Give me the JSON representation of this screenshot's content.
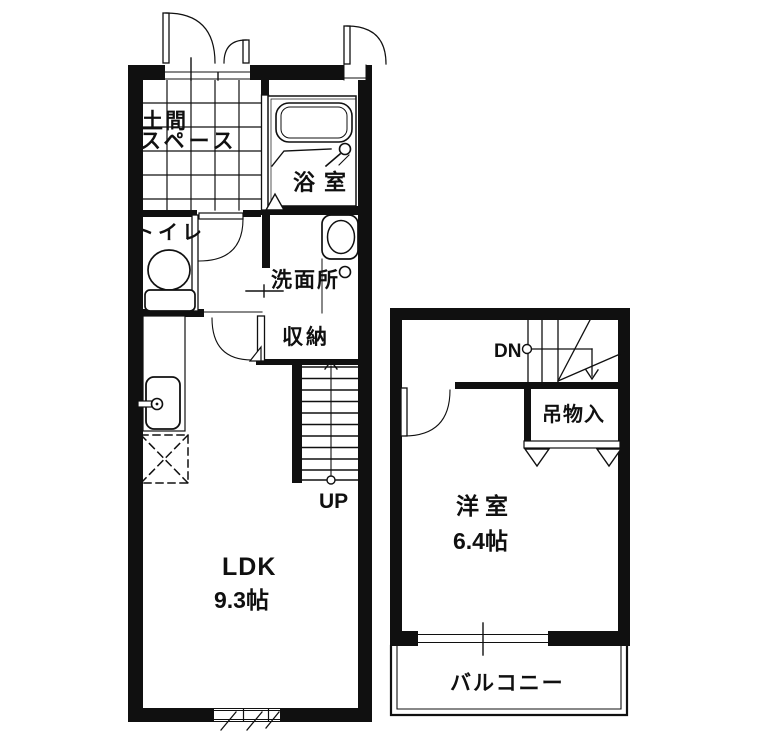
{
  "floor_plan": {
    "first_floor": {
      "doma_line1": "土間",
      "doma_line2": "スペース",
      "bathroom_label": "浴室",
      "toilet_label": "トイレ",
      "washroom_label": "洗面所",
      "storage_label": "収納",
      "stairs_up_label": "UP",
      "ldk_label": "LDK",
      "ldk_size": "9.3帖"
    },
    "second_floor": {
      "stairs_down_label": "DN",
      "closet_label": "吊物入",
      "room_label": "洋室",
      "room_size": "6.4帖",
      "balcony_label": "バルコニー"
    },
    "colors": {
      "line": "#101010",
      "background": "#ffffff"
    }
  }
}
